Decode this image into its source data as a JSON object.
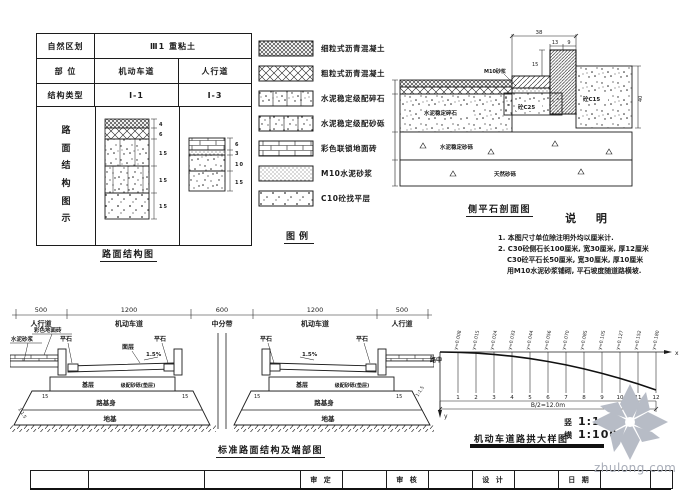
{
  "table": {
    "region_label": "自然区划",
    "region_value": "Ⅲ1  重粘土",
    "part_label": "部  位",
    "part_col1": "机动车道",
    "part_col2": "人行道",
    "type_label": "结构类型",
    "type_col1": "Ⅰ-1",
    "type_col2": "Ⅰ-3",
    "diagram_label": "路面结构图示",
    "stack1_dims": [
      "4",
      "6",
      "15",
      "15",
      "15"
    ],
    "stack2_dims": [
      "6",
      "3",
      "10",
      "15"
    ],
    "title": "路面结构图"
  },
  "legend": {
    "title": "图例",
    "items": [
      {
        "icon": "fine-asphalt-swatch",
        "label": "细粒式沥青混凝土"
      },
      {
        "icon": "coarse-asphalt-swatch",
        "label": "粗粒式沥青混凝土"
      },
      {
        "icon": "crushed-stone-swatch",
        "label": "水泥稳定级配碎石"
      },
      {
        "icon": "gravel-swatch",
        "label": "水泥稳定级配砂砾"
      },
      {
        "icon": "brick-swatch",
        "label": "彩色联锁地面砖"
      },
      {
        "icon": "mortar-swatch",
        "label": "M10水泥砂浆"
      },
      {
        "icon": "concrete-swatch",
        "label": "C10砼找平层"
      }
    ]
  },
  "curb_detail": {
    "title": "侧平石剖面图",
    "dim_top": "38",
    "dim_13": "13",
    "dim_9": "9",
    "dim_15": "15",
    "dim_40": "40",
    "labels": {
      "mortar": "M10砂浆",
      "c15": "砼C15",
      "c25": "砼C25",
      "base": "水泥稳定碎石",
      "subbase": "水泥稳定砂砾",
      "natural": "天然砂砾"
    }
  },
  "notes": {
    "title": "说  明",
    "lines": [
      "1. 本图尺寸单位除注明外均以厘米计.",
      "2. C30砼侧石长100厘米, 宽30厘米, 厚12厘米",
      "C30砼平石长50厘米, 宽30厘米, 厚10厘米",
      "用M10水泥砂浆铺砌, 平石坡度随道路横坡."
    ]
  },
  "cross_section": {
    "title": "标准路面结构及端部图",
    "dims": [
      "500",
      "1200",
      "600",
      "1200",
      "500"
    ],
    "zones": [
      "人行道",
      "机动车道",
      "中分带",
      "机动车道",
      "人行道"
    ],
    "labels": {
      "mortar": "水泥砂浆",
      "brick": "彩色地面砖",
      "flat": "平石",
      "surface": "面层",
      "slope": "1.5%",
      "base": "基层",
      "cushion": "级配砂砾(垫层)",
      "embankment": "路基身",
      "foundation": "地基",
      "edge": "15",
      "side_slope": "1:1.5"
    }
  },
  "crown": {
    "title": "机动车道路拱大样图",
    "v_scale_label": "竖",
    "v_scale": "1:10",
    "h_scale_label": "横",
    "h_scale": "1:100",
    "span": "B/2=12.0m",
    "axis_x": "x",
    "axis_y": "y",
    "center_label": "路中",
    "stations": [
      "1",
      "2",
      "3",
      "4",
      "5",
      "6",
      "7",
      "8",
      "9",
      "10",
      "11",
      "12"
    ],
    "y_values": [
      "y=0.008",
      "y=0.015",
      "y=0.024",
      "y=0.033",
      "y=0.044",
      "y=0.056",
      "y=0.070",
      "y=0.085",
      "y=0.105",
      "y=0.127",
      "y=0.152",
      "y=0.180"
    ]
  },
  "chart_data": {
    "type": "line",
    "title": "机动车道路拱大样图",
    "x": [
      0,
      1,
      2,
      3,
      4,
      5,
      6,
      7,
      8,
      9,
      10,
      11,
      12
    ],
    "series": [
      {
        "name": "路拱曲线 y(m)",
        "values": [
          0,
          0.008,
          0.015,
          0.024,
          0.033,
          0.044,
          0.056,
          0.07,
          0.085,
          0.105,
          0.127,
          0.152,
          0.18
        ]
      }
    ],
    "xlabel": "x",
    "ylabel": "y",
    "annotations": [
      "B/2=12.0m",
      "竖 1:10",
      "横 1:100"
    ]
  },
  "titleblock": {
    "c1": "审  定",
    "c2": "审  核",
    "c3": "设  计",
    "c4": "日  期"
  },
  "watermark": {
    "text": "zhulong.com"
  }
}
